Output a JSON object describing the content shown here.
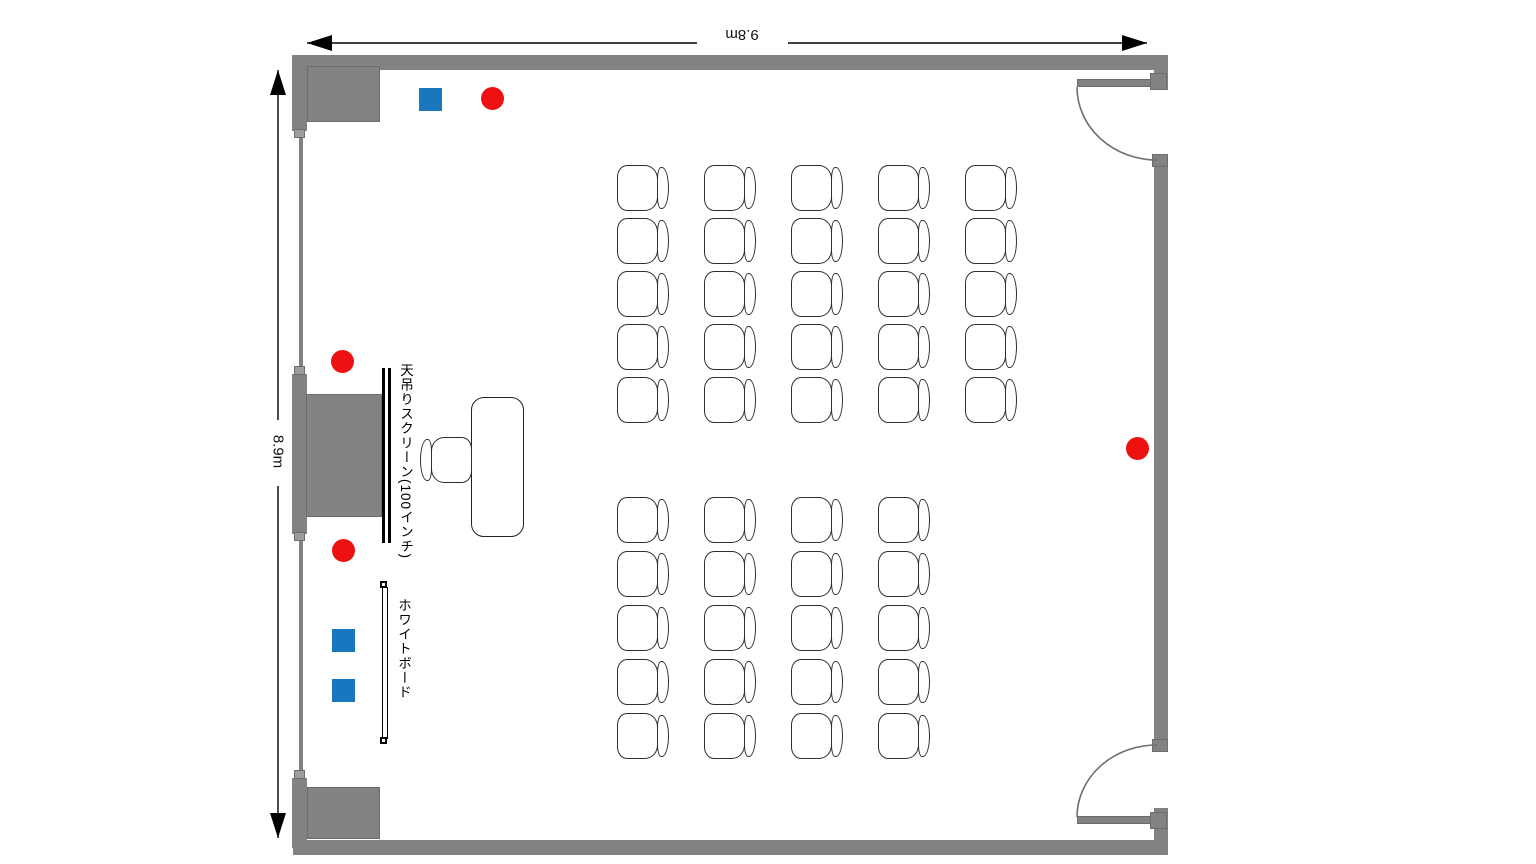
{
  "page": {
    "background": "#ffffff",
    "kind": "seminar-room-floor-plan"
  },
  "dimensions": {
    "width_label": "9.8m",
    "height_label": "8.9m"
  },
  "equipment": {
    "screen_label": "天吊りスクリーン(100インチ)",
    "whiteboard_label": "ホワイトボード"
  },
  "colors": {
    "wall": "#828282",
    "wall_dark": "#6d6d6d",
    "wall_light": "#9d9d9d",
    "outline": "#2f2f2f",
    "marker_red": "#ee1111",
    "marker_blue": "#1877bd",
    "door_arc": "#6f6f6f",
    "dimension_line": "#000000"
  },
  "markers": {
    "red_diameter": 23,
    "blue_size": 23,
    "red_circles": [
      {
        "x": 492,
        "y": 98
      },
      {
        "x": 342,
        "y": 361
      },
      {
        "x": 343,
        "y": 550
      },
      {
        "x": 1137,
        "y": 448
      }
    ],
    "blue_squares": [
      {
        "x": 430,
        "y": 99
      },
      {
        "x": 343,
        "y": 640
      },
      {
        "x": 343,
        "y": 690
      }
    ]
  },
  "seating": {
    "total_chairs": 45,
    "front_block": {
      "rows": 5,
      "cols": 5,
      "origin_x": 617,
      "origin_y": 165,
      "col_gap": 87,
      "row_gap": 53
    },
    "rear_block": {
      "rows": 5,
      "cols": 4,
      "origin_x": 617,
      "origin_y": 497,
      "col_gap": 87,
      "row_gap": 54
    }
  }
}
